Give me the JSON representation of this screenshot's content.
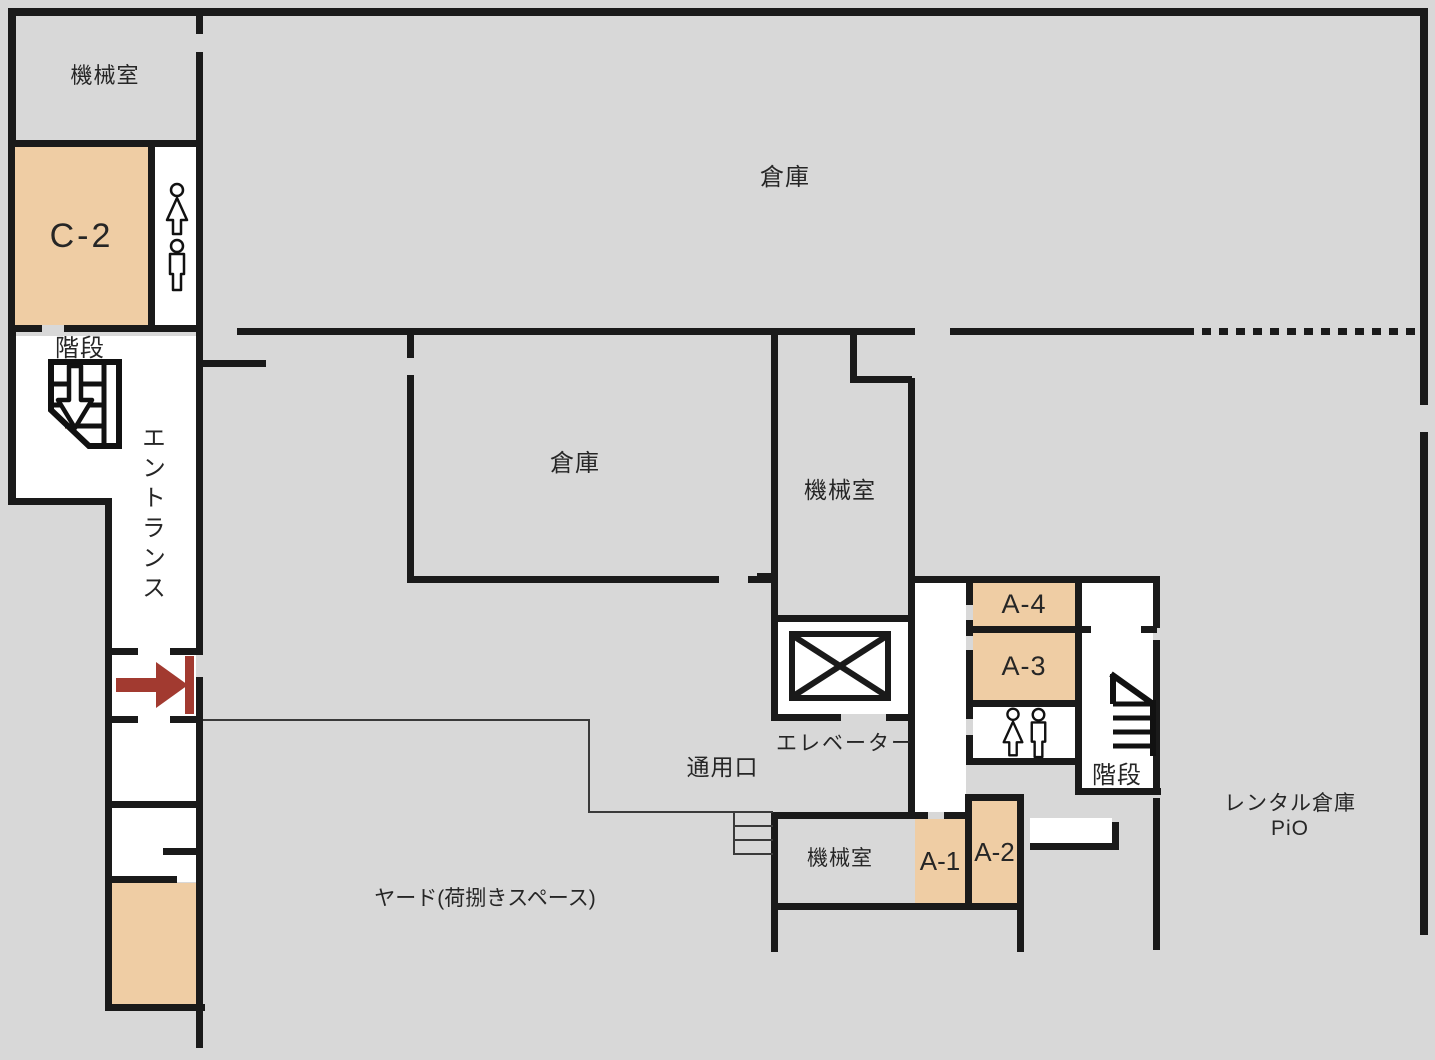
{
  "plan_title": "建物フロアプラン",
  "colors": {
    "background": "#d8d8d8",
    "room_fill": "#efcda4",
    "wall": "#1a1a1a",
    "arrow": "#a23a30",
    "floor_white": "#ffffff",
    "text": "#262626"
  },
  "labels": {
    "machine_room_top_left": "機械室",
    "room_c2": "C-2",
    "stairs_top_left": "階段",
    "entrance_vertical": "エントランス",
    "warehouse_top": "倉庫",
    "warehouse_middle": "倉庫",
    "machine_room_center": "機械室",
    "elevator": "エレベーター",
    "service_entrance": "通用口",
    "room_a4": "A-4",
    "room_a3": "A-3",
    "stairs_right": "階段",
    "machine_room_bottom": "機械室",
    "room_a1": "A-1",
    "room_a2": "A-2",
    "rental_storage_line1": "レンタル倉庫",
    "rental_storage_line2": "PiO",
    "yard": "ヤード(荷捌きスペース)"
  },
  "icons": {
    "toilet_female": "woman-icon",
    "toilet_male": "man-icon",
    "stairs_down": "stairs-down-icon",
    "stairs_flight": "stairs-icon",
    "elevator_cross": "elevator-x-icon",
    "entrance_arrow": "entrance-arrow-icon",
    "service_steps": "steps-icon"
  }
}
